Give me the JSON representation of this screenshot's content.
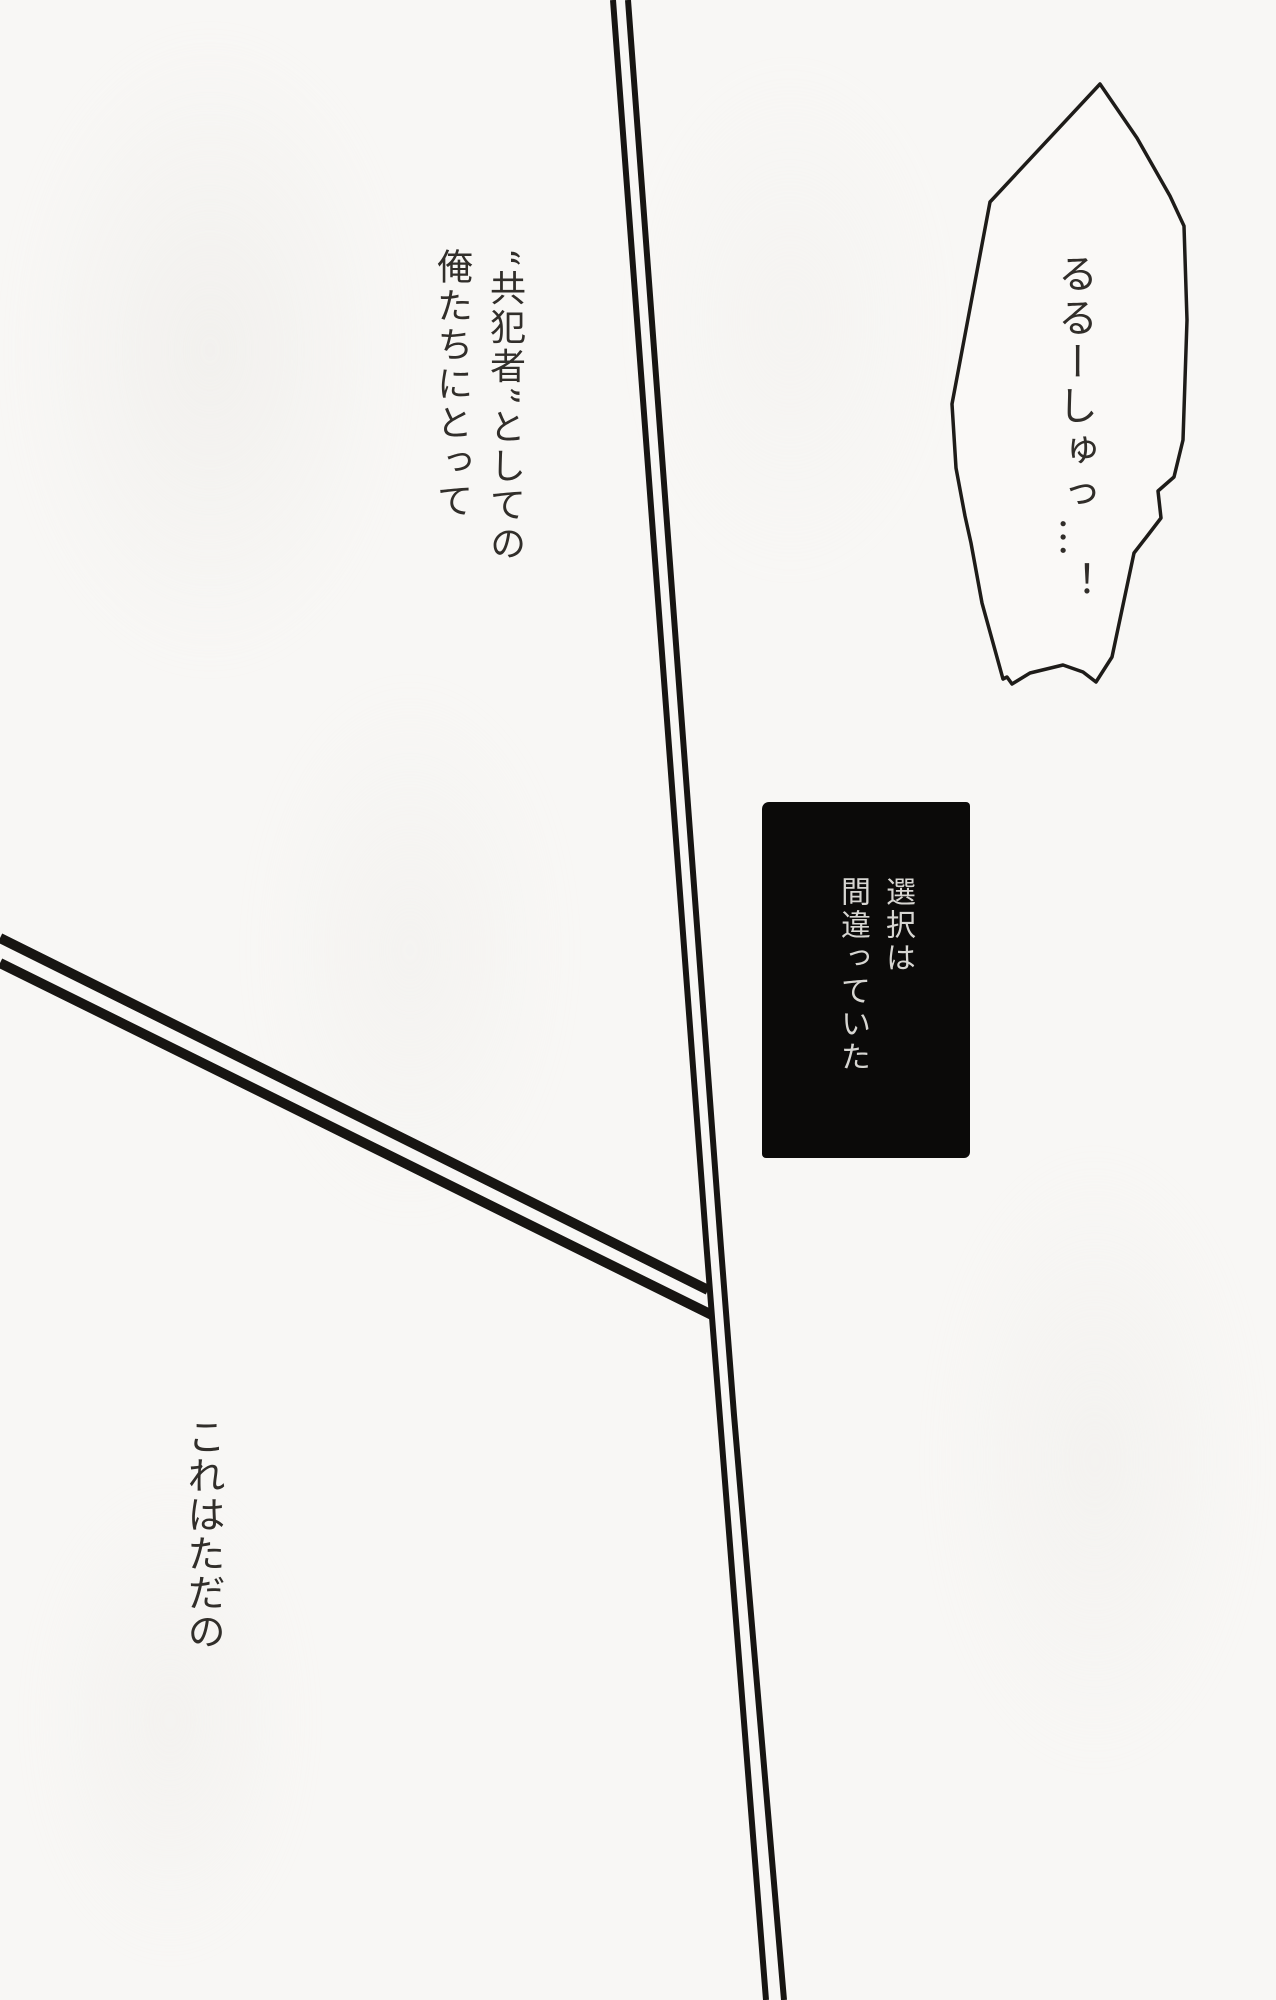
{
  "page": {
    "description": "scanned manga page",
    "paper_color": "#f8f7f5",
    "ink_color": "#1b1917"
  },
  "speech_bubble": {
    "text": "るるーしゅっ…！"
  },
  "catchphrase": {
    "line1": "“共犯者”としての",
    "line2": "俺たちにとって"
  },
  "caption_box": {
    "line1": "選択は",
    "line2": "間違っていた",
    "background_color": "#0b0a09",
    "text_color": "#d7d6d2"
  },
  "bottom_text": {
    "text": "これはただの"
  }
}
